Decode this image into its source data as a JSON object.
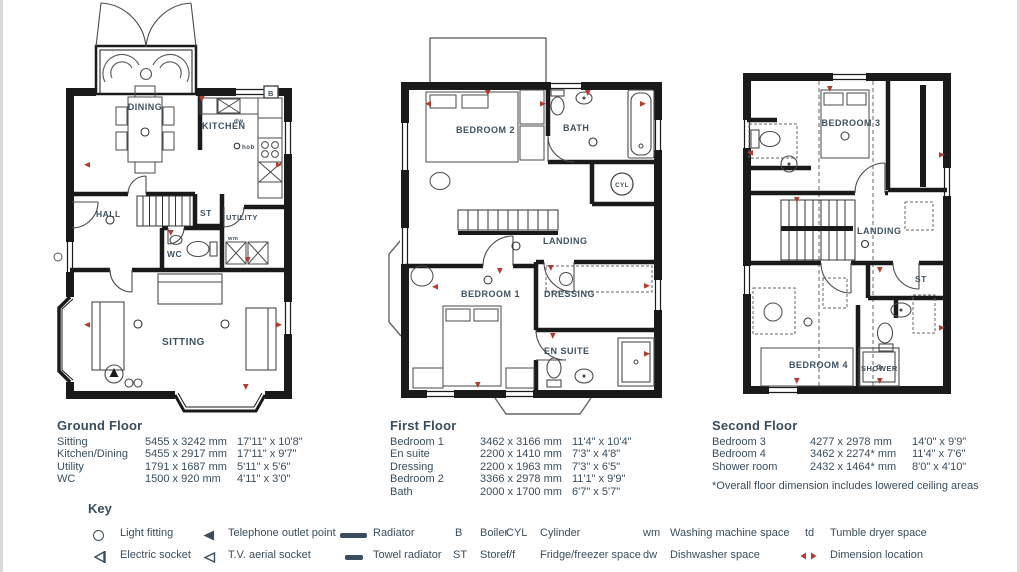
{
  "colors": {
    "text": "#3a4d5c",
    "wall": "#1a1a1a",
    "marker": "#b43b30",
    "background": "#ffffff"
  },
  "ground_floor": {
    "plan_rooms": {
      "dining": "DINING",
      "kitchen": "KITCHEN",
      "hall": "HALL",
      "store": "ST",
      "utility": "UTILITY",
      "wc": "WC",
      "sitting": "SITTING"
    },
    "plan_annotations": {
      "dw": "dw",
      "hob": "hob",
      "boiler": "B",
      "wm": "wm"
    },
    "table": {
      "title": "Ground Floor",
      "rows": [
        {
          "room": "Sitting",
          "mm": "5455 x 3242 mm",
          "imperial": "17'11\" x 10'8\""
        },
        {
          "room": "Kitchen/Dining",
          "mm": "5455 x 2917 mm",
          "imperial": "17'11\" x 9'7\""
        },
        {
          "room": "Utility",
          "mm": "1791 x 1687 mm",
          "imperial": "5'11\" x 5'6\""
        },
        {
          "room": "WC",
          "mm": "1500 x 920 mm",
          "imperial": "4'11\" x 3'0\""
        }
      ]
    }
  },
  "first_floor": {
    "plan_rooms": {
      "bedroom2": "BEDROOM 2",
      "bath": "BATH",
      "cylinder": "CYL",
      "landing": "LANDING",
      "bedroom1": "BEDROOM 1",
      "dressing": "DRESSING",
      "ensuite": "EN SUITE"
    },
    "table": {
      "title": "First Floor",
      "rows": [
        {
          "room": "Bedroom 1",
          "mm": "3462 x 3166 mm",
          "imperial": "11'4\" x 10'4\""
        },
        {
          "room": "En suite",
          "mm": "2200 x 1410 mm",
          "imperial": "7'3\" x 4'8\""
        },
        {
          "room": "Dressing",
          "mm": "2200 x 1963 mm",
          "imperial": "7'3\" x 6'5\""
        },
        {
          "room": "Bedroom 2",
          "mm": "3366 x 2978 mm",
          "imperial": "11'1\" x 9'9\""
        },
        {
          "room": "Bath",
          "mm": "2000 x 1700 mm",
          "imperial": "6'7\" x 5'7\""
        }
      ]
    }
  },
  "second_floor": {
    "plan_rooms": {
      "bedroom3": "BEDROOM 3",
      "landing": "LANDING",
      "store": "ST",
      "bedroom4": "BEDROOM 4",
      "shower": "SHOWER"
    },
    "table": {
      "title": "Second Floor",
      "rows": [
        {
          "room": "Bedroom 3",
          "mm": "4277 x 2978 mm",
          "imperial": "14'0\" x 9'9\""
        },
        {
          "room": "Bedroom 4",
          "mm": "3462 x 2274* mm",
          "imperial": "11'4\" x 7'6\""
        },
        {
          "room": "Shower room",
          "mm": "2432 x 1464* mm",
          "imperial": "8'0\" x 4'10\""
        }
      ],
      "footnote": "*Overall floor dimension includes lowered ceiling areas"
    }
  },
  "key": {
    "title": "Key",
    "row1": [
      {
        "label": "Light fitting"
      },
      {
        "label": "Telephone outlet point"
      },
      {
        "label": "Radiator"
      },
      {
        "abbr": "B",
        "label": "Boiler"
      },
      {
        "abbr": "CYL",
        "label": "Cylinder"
      },
      {
        "abbr": "wm",
        "label": "Washing machine space"
      },
      {
        "abbr": "td",
        "label": "Tumble dryer space"
      }
    ],
    "row2": [
      {
        "label": "Electric socket"
      },
      {
        "label": "T.V. aerial socket"
      },
      {
        "label": "Towel radiator"
      },
      {
        "abbr": "ST",
        "label": "Store"
      },
      {
        "abbr": "f/f",
        "label": "Fridge/freezer space"
      },
      {
        "abbr": "dw",
        "label": "Dishwasher space"
      },
      {
        "label": "Dimension location"
      }
    ]
  }
}
